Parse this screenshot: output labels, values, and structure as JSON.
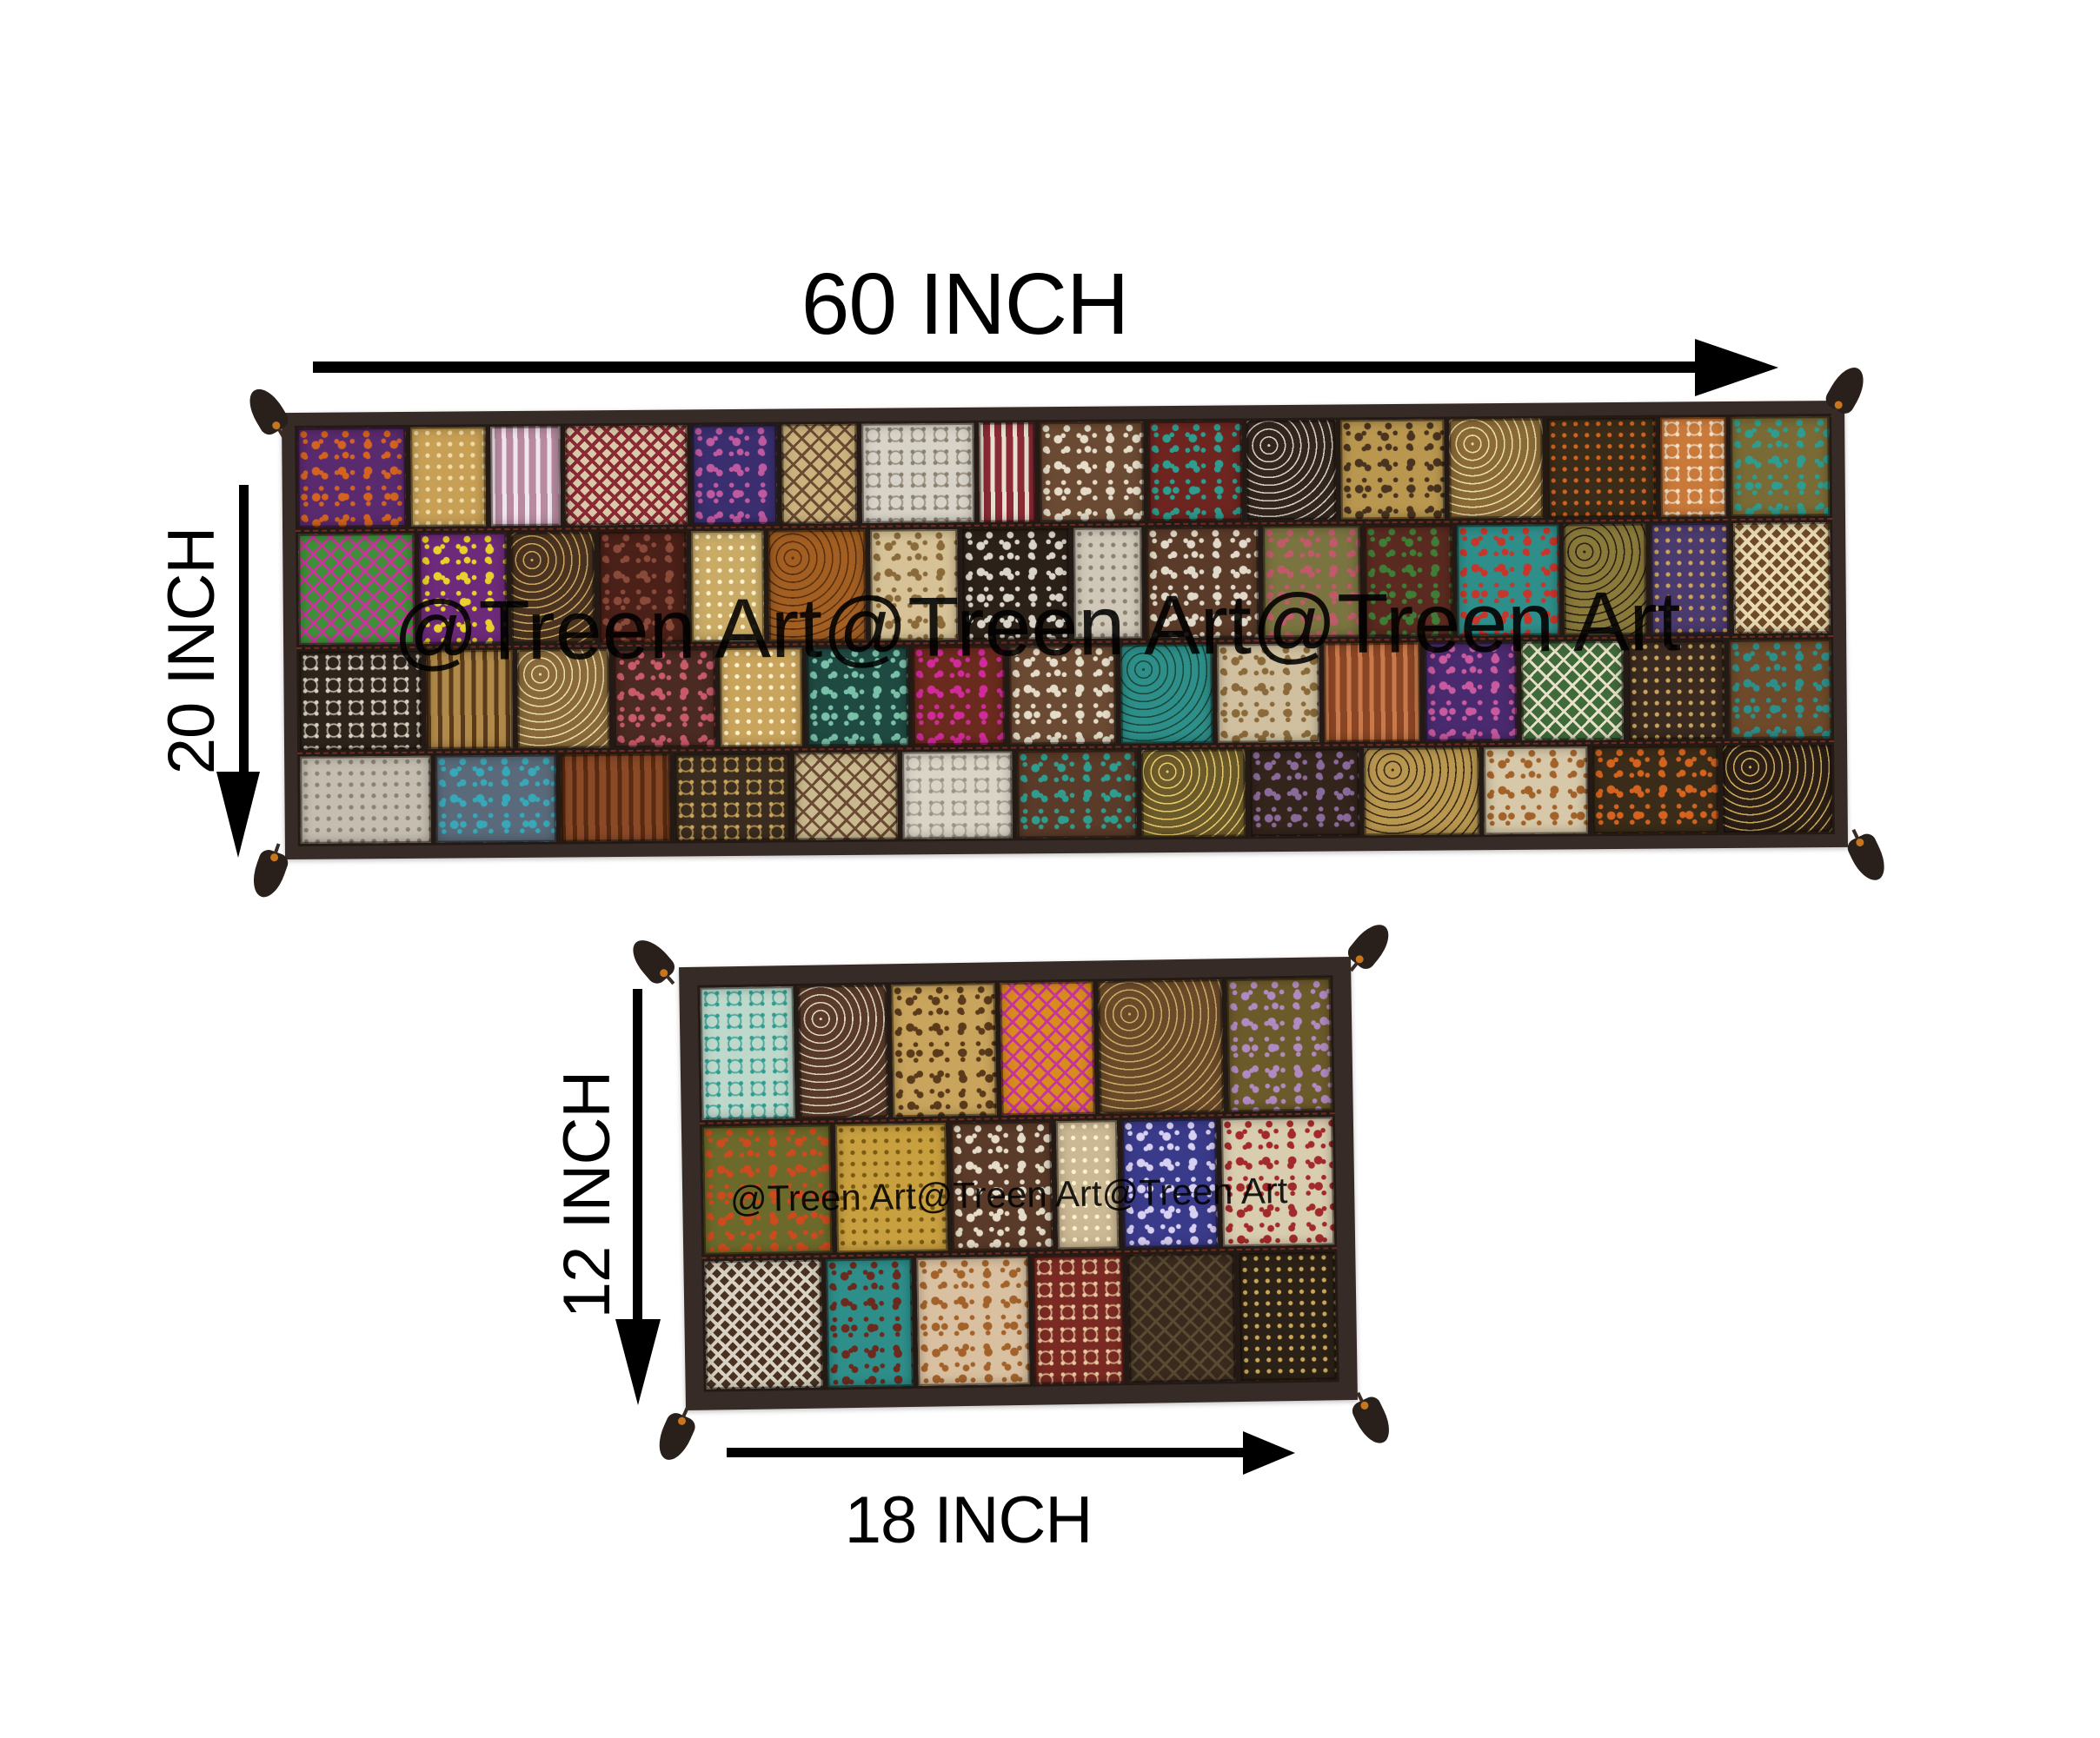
{
  "labels": {
    "runner_width": "60 INCH",
    "runner_height": "20 INCH",
    "mat_height": "12 INCH",
    "mat_width": "18 INCH"
  },
  "watermark": {
    "text": "@Treen Art@Treen Art@Treen Art"
  },
  "colors": {
    "annotation": "#000000",
    "textile_border": "#362b26",
    "seam": "#241a15",
    "tassel": "#29201c",
    "bead_accent": "#c8761e",
    "stitch_red": "#be3c28"
  },
  "runner": {
    "name": "patchwork-table-runner-60x20",
    "row_heights": [
      0.25,
      0.28,
      0.25,
      0.22
    ],
    "rows": [
      [
        [
          "#5a2a6e",
          "#d4631f",
          "floral",
          1.15
        ],
        [
          "#c8a055",
          "#f0dca8",
          "dots",
          0.8
        ],
        [
          "#b88aa0",
          "#f2e6ee",
          "stripes",
          0.75
        ],
        [
          "#d9c9a8",
          "#8a2a35",
          "zigzag",
          1.3
        ],
        [
          "#3a2e6e",
          "#c05aa0",
          "floral",
          0.9
        ],
        [
          "#cbb37e",
          "#6b4a33",
          "diamond",
          0.8
        ],
        [
          "#d8d3c8",
          "#8a8070",
          "lace",
          1.2
        ],
        [
          "#8a2a35",
          "#e8e0d0",
          "stripes",
          0.6
        ],
        [
          "#6b4a33",
          "#e4dcc8",
          "floral",
          1.1
        ],
        [
          "#6e2520",
          "#2e9d8f",
          "floral",
          1.0
        ],
        [
          "#33261f",
          "#d5cdc0",
          "scroll",
          0.95
        ],
        [
          "#b9974f",
          "#4a3320",
          "floral",
          1.1
        ],
        [
          "#8a6a35",
          "#e8d9a8",
          "scroll",
          1.0
        ],
        [
          "#3a2c18",
          "#d4631f",
          "dots",
          1.15
        ],
        [
          "#c97a3a",
          "#f2e0c8",
          "lace",
          0.7
        ],
        [
          "#7a6a35",
          "#2e9d8f",
          "floral",
          1.05
        ]
      ],
      [
        [
          "#3f8f3a",
          "#c8359a",
          "diamond",
          1.2
        ],
        [
          "#6e2a7a",
          "#e8d12a",
          "floral",
          0.9
        ],
        [
          "#4a3320",
          "#c9a45c",
          "scroll",
          0.85
        ],
        [
          "#4a2018",
          "#8a4a3a",
          "floral",
          0.9
        ],
        [
          "#c9ab66",
          "#fff2cc",
          "dots",
          0.75
        ],
        [
          "#a35f22",
          "#5a3010",
          "scroll",
          1.0
        ],
        [
          "#d6c296",
          "#8a6a3a",
          "floral",
          0.9
        ],
        [
          "#2b2118",
          "#d9d4c9",
          "floral",
          1.1
        ],
        [
          "#cfc8b8",
          "#8a8070",
          "dots",
          0.7
        ],
        [
          "#5a3a28",
          "#e0d8c8",
          "floral",
          1.15
        ],
        [
          "#7a7440",
          "#c05a6a",
          "floral",
          1.0
        ],
        [
          "#5a2a20",
          "#3f7d36",
          "floral",
          0.9
        ],
        [
          "#2e8f8a",
          "#c8352a",
          "floral",
          1.05
        ],
        [
          "#8a7a3a",
          "#2b2118",
          "scroll",
          0.85
        ],
        [
          "#4a3a6e",
          "#c9a45c",
          "dots",
          0.8
        ],
        [
          "#6e4a2a",
          "#e8d9b0",
          "zigzag",
          1.0
        ]
      ],
      [
        [
          "#2e241c",
          "#d9d2c2",
          "lace",
          1.2
        ],
        [
          "#b08a4a",
          "#5a3a1a",
          "stripes",
          0.85
        ],
        [
          "#8a6a3a",
          "#e8d9a8",
          "scroll",
          0.9
        ],
        [
          "#4a2a22",
          "#c85a6a",
          "floral",
          1.0
        ],
        [
          "#c9a45c",
          "#fff2cc",
          "dots",
          0.8
        ],
        [
          "#1f4a42",
          "#7ac0a8",
          "floral",
          1.0
        ],
        [
          "#6b2a1e",
          "#d12a9a",
          "floral",
          0.9
        ],
        [
          "#6b4a33",
          "#e4dcc8",
          "floral",
          1.05
        ],
        [
          "#2e8f8a",
          "#1a4a3a",
          "scroll",
          0.9
        ],
        [
          "#d0c0a0",
          "#8a6a3a",
          "floral",
          1.0
        ],
        [
          "#8a4525",
          "#c87a4a",
          "stripes",
          0.95
        ],
        [
          "#4a2a6e",
          "#c85aa0",
          "floral",
          0.9
        ],
        [
          "#3f6a3a",
          "#e8e0c8",
          "diamond",
          1.0
        ],
        [
          "#3a2a20",
          "#c9a45c",
          "dots",
          0.95
        ],
        [
          "#6e4a2a",
          "#2e8f8a",
          "floral",
          1.0
        ]
      ],
      [
        [
          "#c5beb0",
          "#8a8274",
          "dots",
          1.2
        ],
        [
          "#5a6a7a",
          "#38a8b8",
          "floral",
          1.1
        ],
        [
          "#8a4a28",
          "#5a2a10",
          "stripes",
          1.0
        ],
        [
          "#3a2c1e",
          "#c9a45c",
          "lace",
          1.05
        ],
        [
          "#c9b98e",
          "#6b4a33",
          "diamond",
          0.95
        ],
        [
          "#d9d4c6",
          "#9a9488",
          "lace",
          1.0
        ],
        [
          "#5a3a28",
          "#2e9d8f",
          "floral",
          1.1
        ],
        [
          "#6b5a2a",
          "#e8c86a",
          "scroll",
          0.95
        ],
        [
          "#33241c",
          "#8a6a9a",
          "floral",
          1.0
        ],
        [
          "#b9974f",
          "#3a2c18",
          "scroll",
          1.05
        ],
        [
          "#d6c8a8",
          "#a3622a",
          "floral",
          0.95
        ],
        [
          "#3a2c18",
          "#d4631f",
          "floral",
          1.15
        ],
        [
          "#2b1f16",
          "#caa75a",
          "scroll",
          1.0
        ]
      ]
    ]
  },
  "mat": {
    "name": "patchwork-table-mat-18x12",
    "row_heights": [
      0.34,
      0.33,
      0.33
    ],
    "rows": [
      [
        [
          "#bfd8cc",
          "#2e9d8f",
          "lace",
          0.9
        ],
        [
          "#5a3a28",
          "#d9d0c0",
          "scroll",
          0.85
        ],
        [
          "#c9a45c",
          "#5a3a1a",
          "floral",
          1.0
        ],
        [
          "#d98a20",
          "#c8359a",
          "diamond",
          0.9
        ],
        [
          "#6b4a2a",
          "#c9ab66",
          "scroll",
          1.2
        ],
        [
          "#6b5a2a",
          "#b08ac0",
          "floral",
          1.0
        ]
      ],
      [
        [
          "#6b6a2a",
          "#cc4a1e",
          "floral",
          1.15
        ],
        [
          "#c9a040",
          "#7a5a10",
          "dots",
          1.0
        ],
        [
          "#5a3a28",
          "#e4dcc8",
          "floral",
          0.9
        ],
        [
          "#cbb894",
          "#fff2cc",
          "dots",
          0.55
        ],
        [
          "#3a3a8a",
          "#d8d0f0",
          "floral",
          0.85
        ],
        [
          "#d9cdb0",
          "#a32a2a",
          "floral",
          1.0
        ]
      ],
      [
        [
          "#4a3222",
          "#d9d2c2",
          "zigzag",
          1.1
        ],
        [
          "#2e8f8a",
          "#6b2a1e",
          "floral",
          0.8
        ],
        [
          "#d9c0a0",
          "#a3622a",
          "floral",
          1.05
        ],
        [
          "#7a2a22",
          "#e8c8a0",
          "lace",
          0.85
        ],
        [
          "#3a2a1e",
          "#5a4a32",
          "diamond",
          1.0
        ],
        [
          "#2b2116",
          "#caa75a",
          "dots",
          0.9
        ]
      ]
    ]
  }
}
